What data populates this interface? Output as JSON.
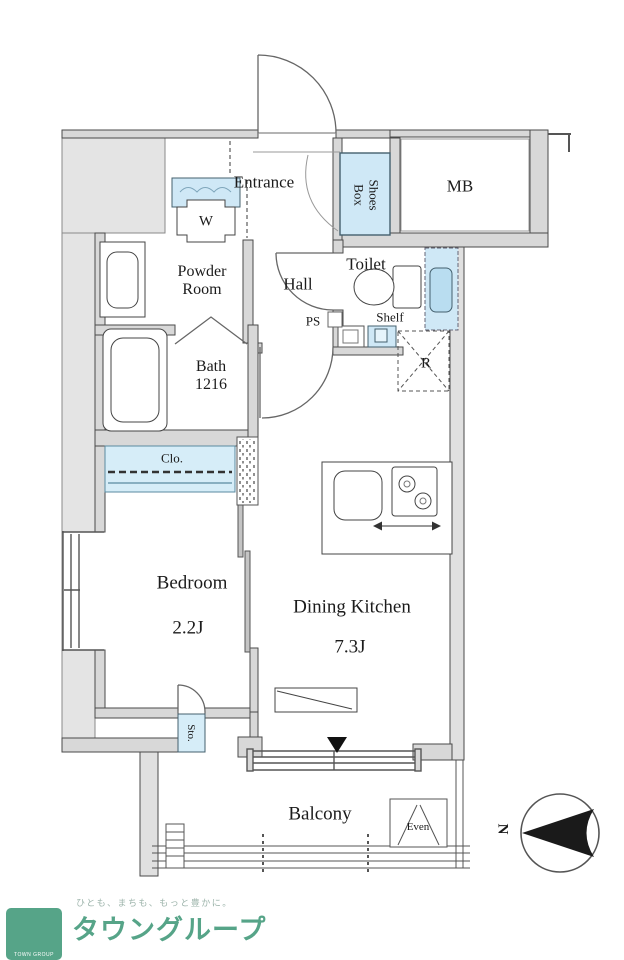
{
  "floorplan": {
    "rooms": {
      "entrance": "Entrance",
      "shoes_line1": "Shoes",
      "shoes_line2": "Box",
      "mb": "MB",
      "toilet": "Toilet",
      "shelf": "Shelf",
      "ps": "PS",
      "hall": "Hall",
      "powder_line1": "Powder",
      "powder_line2": "Room",
      "washer": "W",
      "bath_line1": "Bath",
      "bath_line2": "1216",
      "closet": "Clo.",
      "bedroom": "Bedroom",
      "bedroom_size": "2.2J",
      "dining_kitchen": "Dining Kitchen",
      "dining_kitchen_size": "7.3J",
      "storage": "Sto.",
      "balcony": "Balcony",
      "fridge": "R",
      "evac_hatch": "Even"
    },
    "compass": {
      "north": "N"
    },
    "colors": {
      "wall_gray": "#d8d8d8",
      "light_band": "#e4e4e4",
      "fixture_blue": "#cfe8f6",
      "fixture_blue_deep": "#b9ddf0",
      "line_dark": "#4a4a4a",
      "logo_green": "#56a488"
    }
  },
  "footer": {
    "tagline": "ひとも、まちも、もっと豊かに。",
    "company": "タウングループ",
    "logo_caption": "TOWN GROUP"
  }
}
